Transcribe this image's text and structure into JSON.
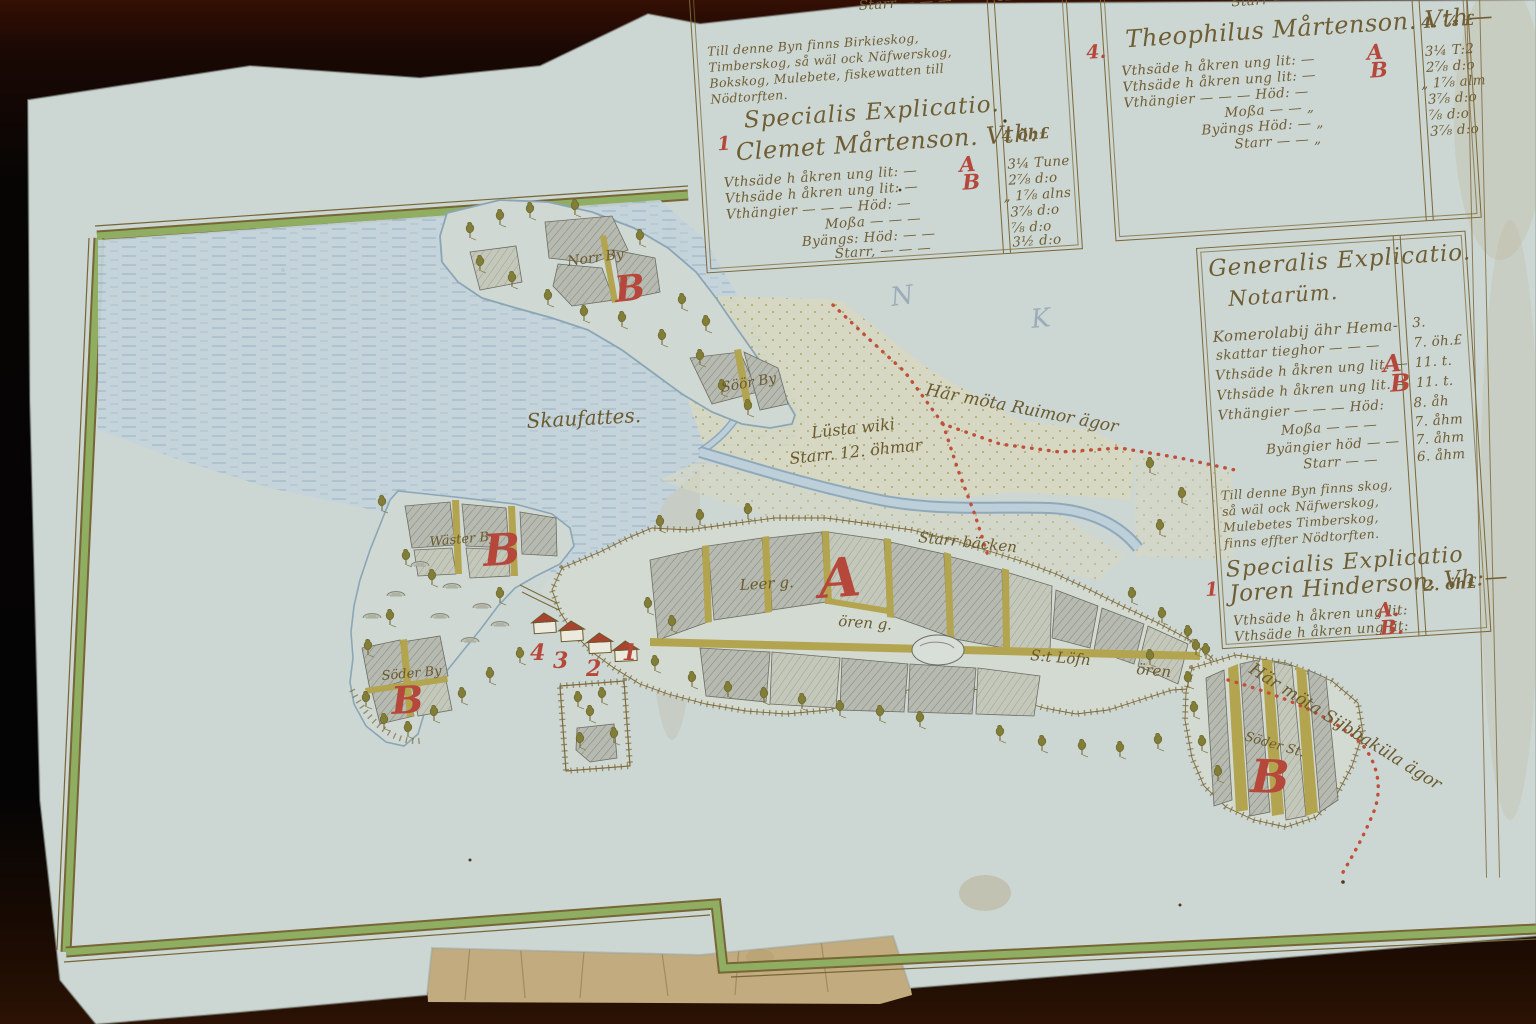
{
  "colors": {
    "paper": "#ccd6d3",
    "ink": "#6f5d33",
    "red_accent": "#b5483a",
    "frame_green": "#8fae62",
    "water": "#c4d4dc",
    "field_grey": "#b6bab0",
    "balk_olive": "#b3a44f"
  },
  "panels": {
    "clemet": {
      "marker": "1",
      "pre_rows": [
        {
          "label": "Byängs Höd: — — —",
          "value": "1½. d."
        },
        {
          "label": "Starr — — —",
          "value": "12. åh."
        }
      ],
      "note": "Till denne Byn finns Birkieskog, Timberskog, så wäl ock Näfwerskog, Bokskog, Mulebete, fiskewatten till Nödtorften.",
      "heading": "Specialis Explicatio.",
      "name": "Clemet Mårtenson. Vth:",
      "name_value": "4 öh£",
      "rows": [
        {
          "label": "Vthsäde h åkren ung lit: —",
          "letter": "A",
          "value": "3¼ Tune"
        },
        {
          "label": "Vthsäde h åkren ung lit: —",
          "letter": "B",
          "value": "2⅞ d:o"
        },
        {
          "label": "Vthängier — — — Höd: —",
          "value": "„ 1⅞ alns"
        },
        {
          "label": "Moßa — — —",
          "value": "3⅞ d:o"
        },
        {
          "label": "Byängs: Höd: — —",
          "value": "⅞ d:o"
        },
        {
          "label": "Starr, — — —",
          "value": "3½ d:o"
        }
      ]
    },
    "theophilus": {
      "marker": "4.",
      "pre_rows": [
        {
          "label": "Starr — — —",
          "value": "3⅞ d."
        }
      ],
      "name": "Theophilus Mårtenson. Vth—",
      "name_value": "4. ⅞ £",
      "rows": [
        {
          "label": "Vthsäde h åkren ung lit: —",
          "letter": "A",
          "value": "3¼ T:2"
        },
        {
          "label": "Vthsäde h åkren ung lit: —",
          "letter": "B",
          "value": "2⅞ d:o"
        },
        {
          "label": "Vthängier — — — Höd: —",
          "value": "„ 1⅞ alm"
        },
        {
          "label": "Moßa — — „",
          "value": "3⅞ d:o"
        },
        {
          "label": "Byängs Höd: — „",
          "value": "⅞ d:o"
        },
        {
          "label": "Starr — — „",
          "value": "3⅞ d:o"
        }
      ]
    },
    "generalis": {
      "heading1": "Generalis Explicatio.",
      "heading2": "Notarüm.",
      "rows": [
        {
          "label": "Komerolabij ähr Hema-",
          "value": "3."
        },
        {
          "label": "skattar tieghor — — —",
          "value": "7. öh.£"
        },
        {
          "label": "Vthsäde h åkren ung lit. —",
          "letter": "A",
          "value": "11. t."
        },
        {
          "label": "Vthsäde h åkren ung lit. —",
          "letter": "B",
          "value": "11. t."
        },
        {
          "label": "Vthängier — — — Höd:",
          "value": "8. åh"
        },
        {
          "label": "Moßa — — —",
          "value": "7. åhm"
        },
        {
          "label": "Byängier höd — —",
          "value": "7. åhm"
        },
        {
          "label": "Starr — —",
          "value": "6. åhm"
        }
      ],
      "note": "Till denne Byn finns skog, så wäl ock Näfwerskog, Mulebetes Timberskog, finns effter Nödtorften.",
      "heading3": "Specialis Explicatio",
      "name": "Joren Hinderson. Vh:—",
      "name_value": "2. öh£",
      "marker": "1",
      "rows2": [
        {
          "label": "Vthsäde h åkren ung lit:",
          "letter": "A."
        },
        {
          "label": "Vthsäde h åkren ung lit:",
          "letter": "B."
        }
      ]
    }
  },
  "map": {
    "water_label": "Skaufattes.",
    "pencil_marks": [
      "N",
      "K"
    ],
    "boundary_labels": {
      "north": "Här möta Ruimor ägor",
      "southeast": "Här möta Sijbbaküla ägor"
    },
    "meadow_label_line1": "Lüsta wiki",
    "meadow_label_line2": "Starr. 12. öhmar",
    "stream_label": "Starr bäcken",
    "field_labels": {
      "leer": "Leer g.",
      "oren_mid": "ören g.",
      "st_lofn": "S:t Löfn",
      "oren_east": "ören",
      "island_nw": "Norr By",
      "island_se": "Söör By",
      "peninsula_north": "Wäster By",
      "peninsula_south": "Söder By",
      "right_block": "Söder St."
    },
    "section_letters": {
      "a_main": "A",
      "b_peninsula_north": "B",
      "b_peninsula_south": "B",
      "b_island": "B",
      "b_southeast": "B"
    },
    "house_numbers": [
      "4",
      "3",
      "2",
      "1"
    ]
  }
}
